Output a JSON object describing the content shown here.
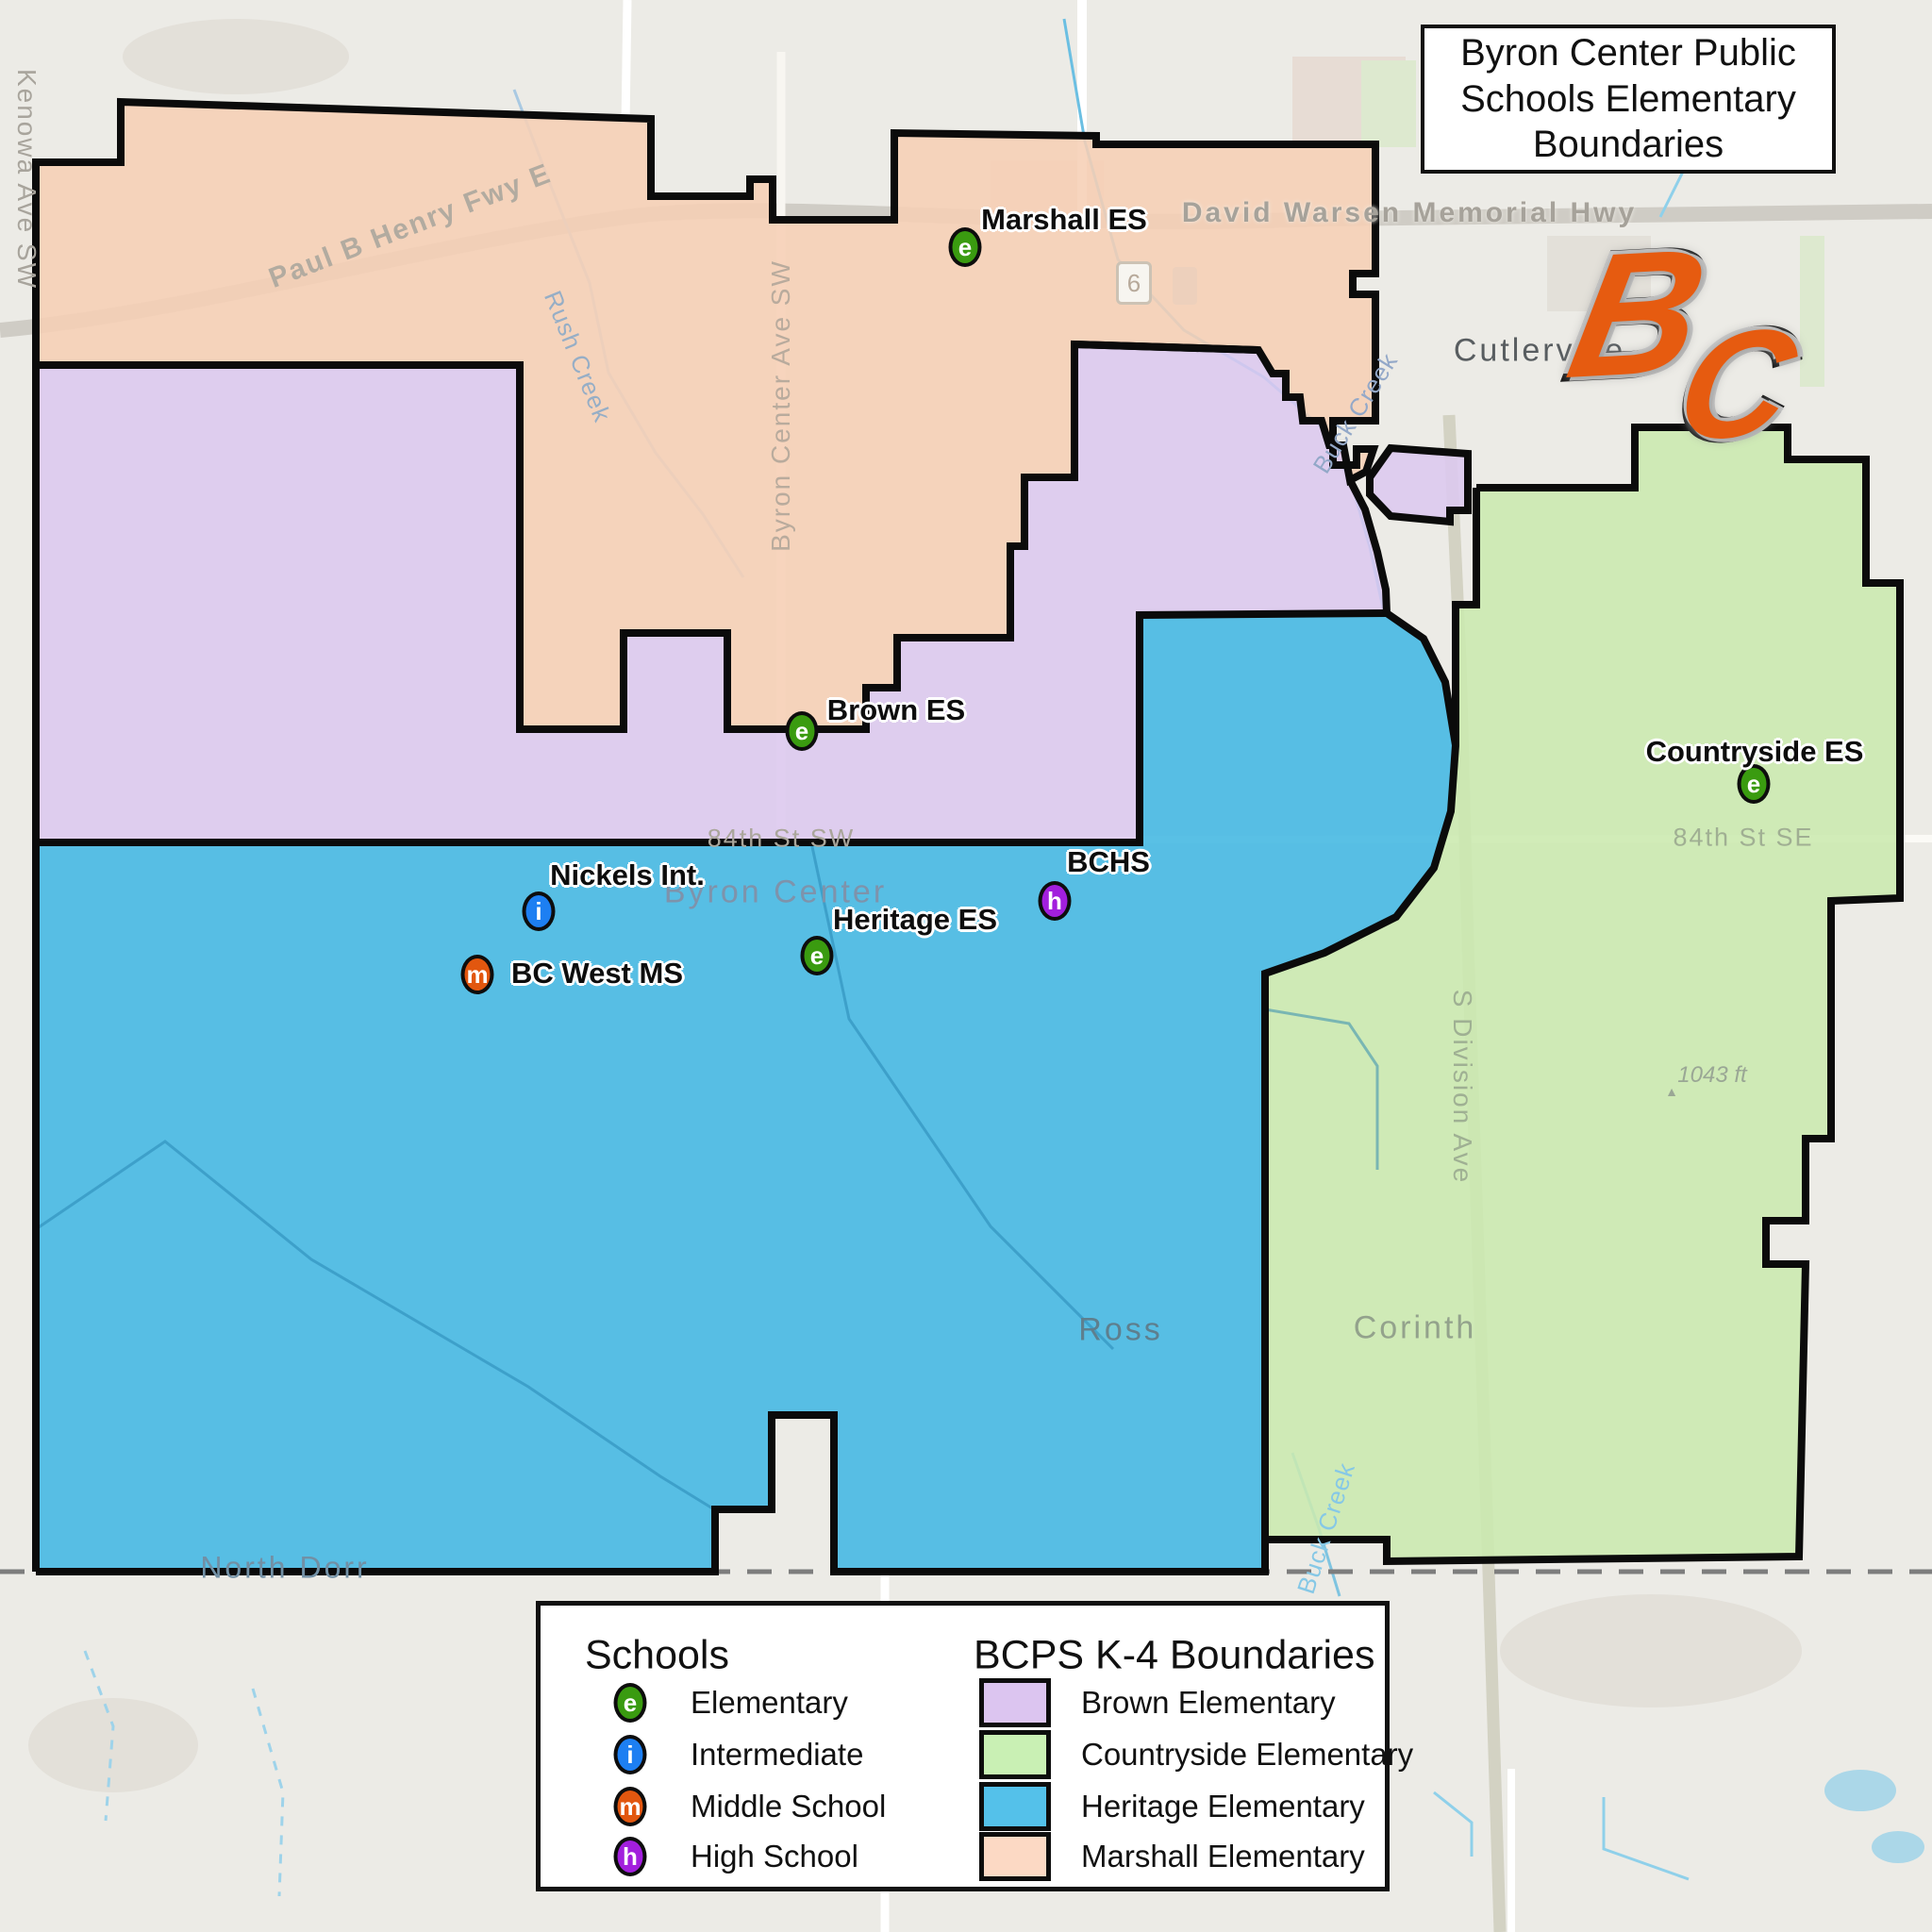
{
  "title": "Byron Center Public Schools Elementary Boundaries",
  "logo": {
    "letter_b": "B",
    "letter_c": "C",
    "color": "#e65b10"
  },
  "colors": {
    "marshall": "#f6cfb5",
    "brown": "#dcc8ef",
    "heritage": "#47b9e3",
    "countryside": "#cbe9af",
    "marker_e": "#3a9b10",
    "marker_i": "#1d7ff2",
    "marker_m": "#e2570f",
    "marker_h": "#a21fdd"
  },
  "map": {
    "schools": [
      {
        "name": "Marshall ES",
        "marker": "e"
      },
      {
        "name": "Brown ES",
        "marker": "e"
      },
      {
        "name": "Countryside ES",
        "marker": "e"
      },
      {
        "name": "Nickels Int.",
        "marker": "i"
      },
      {
        "name": "BC West MS",
        "marker": "m"
      },
      {
        "name": "Heritage ES",
        "marker": "e"
      },
      {
        "name": "BCHS",
        "marker": "h"
      }
    ],
    "towns": {
      "cutlerville": "Cutlerville",
      "byron_center": "Byron Center",
      "ross": "Ross",
      "corinth": "Corinth",
      "north_dorr": "North Dorr"
    },
    "roads": {
      "paul_b_henry": "Paul B Henry Fwy E",
      "david_warsen": "David Warsen Memorial Hwy",
      "byron_center_ave": "Byron Center Ave SW",
      "kenowa_ave": "Kenowa Ave SW",
      "st84_sw": "84th St SW",
      "st84_se": "84th St SE",
      "s_division": "S Division Ave",
      "route_shield": "6"
    },
    "creeks": {
      "rush": "Rush Creek",
      "buck_upper": "Buck Creek",
      "buck_lower": "Buck Creek"
    },
    "elevation": "1043 ft"
  },
  "legend": {
    "schools_heading": "Schools",
    "school_types": [
      {
        "letter": "e",
        "label": "Elementary",
        "color": "#3a9b10"
      },
      {
        "letter": "i",
        "label": "Intermediate",
        "color": "#1d7ff2"
      },
      {
        "letter": "m",
        "label": "Middle School",
        "color": "#e2570f"
      },
      {
        "letter": "h",
        "label": "High School",
        "color": "#a21fdd"
      }
    ],
    "boundaries_heading": "BCPS K-4 Boundaries",
    "boundaries": [
      {
        "label": "Brown Elementary",
        "color": "#dcc5f0"
      },
      {
        "label": "Countryside Elementary",
        "color": "#c9f0b4"
      },
      {
        "label": "Heritage Elementary",
        "color": "#54c1ea"
      },
      {
        "label": "Marshall Elementary",
        "color": "#fcd9c4"
      }
    ]
  }
}
